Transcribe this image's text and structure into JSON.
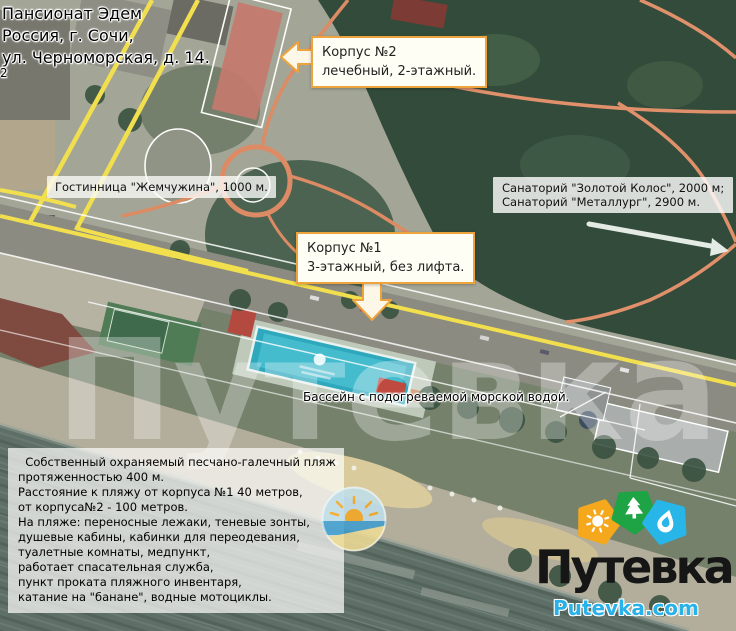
{
  "map": {
    "watermark": "Путевка",
    "address": {
      "line1": "Пансионат Эдем",
      "line2": "Россия, г. Сочи,",
      "line3": "ул. Черноморская, д. 14."
    },
    "labels": {
      "hotel_distance": "Гостинница \"Жемчужина\", 1000 м.",
      "sanatorium_line1": "Санаторий \"Золотой Колос\", 2000 м;",
      "sanatorium_line2": "Санаторий \"Металлург\", 2900 м.",
      "pool": "Бассейн с подогреваемой морской водой.",
      "edge_number": "2"
    },
    "callouts": {
      "korpus2_title": "Корпус №2",
      "korpus2_desc": "лечебный, 2-этажный.",
      "korpus1_title": "Корпус №1",
      "korpus1_desc": "3-этажный, без лифта."
    },
    "beach_info_lines": [
      "  Собственный охраняемый песчано-галечный пляж",
      "протяженностью 400 м.",
      "Расстояние к пляжу от корпуса №1 40 метров,",
      "от корпуса№2 - 100 метров.",
      "На пляже: переносные лежаки, теневые зонты,",
      "душевые кабины, кабинки для переодевания,",
      "туалетные комнаты, медпункт,",
      "работает спасательная служба,",
      "пункт проката пляжного инвентаря,",
      "катание на \"банане\", водные мотоциклы."
    ]
  },
  "logo": {
    "brand": "Путевка",
    "domain": "Putevka.com",
    "badges": [
      {
        "icon": "sun-icon",
        "color": "#f5a81c"
      },
      {
        "icon": "tree-icon",
        "color": "#1ea345"
      },
      {
        "icon": "drop-icon",
        "color": "#28b5e8"
      }
    ]
  },
  "colors": {
    "callout_border": "#eda43c",
    "road_yellow": "#f2df4e",
    "path_salmon": "#dd8b64",
    "forest_green": "#324b3b",
    "sea": "#5e6f68",
    "pool_water": "#2ea8bd",
    "logo_text": "#161616",
    "logo_domain_blue": "#29b1e9"
  }
}
